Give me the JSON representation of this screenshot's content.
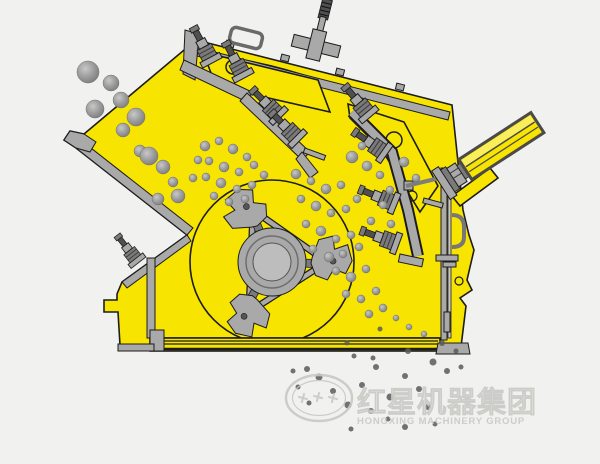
{
  "meta": {
    "description": "Cross-section working-principle diagram of an impact crusher (animation frame): rocks fall down the feed chute onto a spinning three-hammer rotor and are thrown against two spring-loaded impact aprons; crushed fines discharge below the base.",
    "width": 600,
    "height": 464
  },
  "colors": {
    "background": "#f1f1ef",
    "body_yellow": "#f7e400",
    "body_yellow_light": "#faef5a",
    "ink": "#1c1c1c",
    "steel": "#a9a9a9",
    "steel_light": "#c9c9c9",
    "steel_dark": "#7a7a7a",
    "steel_darker": "#4f4f4f",
    "rock_light": "#c8c8c8",
    "rock_mid": "#9a9a9a",
    "rock_dark": "#787878",
    "fines": "#5a5a5a",
    "watermark_line": "#c9c9c4",
    "watermark_fill": "#eaeae6"
  },
  "watermark": {
    "logo": "hongxing-oval-logo",
    "cn": "红星机器集团",
    "en": "HONGXING MACHINERY GROUP"
  },
  "parts": [
    {
      "id": "machine-frame",
      "label": "Yellow crusher housing / frame"
    },
    {
      "id": "feed-chute",
      "label": "Inclined feed chute with flange lip"
    },
    {
      "id": "feed-rocks",
      "label": "Raw rocks entering the feed opening"
    },
    {
      "id": "top-cover",
      "label": "Bolted top cover with liner"
    },
    {
      "id": "lift-handle",
      "label": "Lifting handle on top cover"
    },
    {
      "id": "tension-rod",
      "label": "Threaded tension rod with cross bracket"
    },
    {
      "id": "upper-impact-apron",
      "label": "First impact apron with spring bolts"
    },
    {
      "id": "lower-impact-apron",
      "label": "Second impact apron with spring bolts"
    },
    {
      "id": "rotor",
      "label": "Rotor with three blow-bar hammers"
    },
    {
      "id": "rotor-hub",
      "label": "Rotor hub and shaft"
    },
    {
      "id": "adjusting-cylinder",
      "label": "Apron gap adjusting cylinder"
    },
    {
      "id": "base-frame",
      "label": "Base rails and mounting feet"
    },
    {
      "id": "chamber-rocks",
      "label": "Material being crushed in the chamber"
    },
    {
      "id": "crushed-material",
      "label": "Crushed fines discharging under the base"
    }
  ]
}
